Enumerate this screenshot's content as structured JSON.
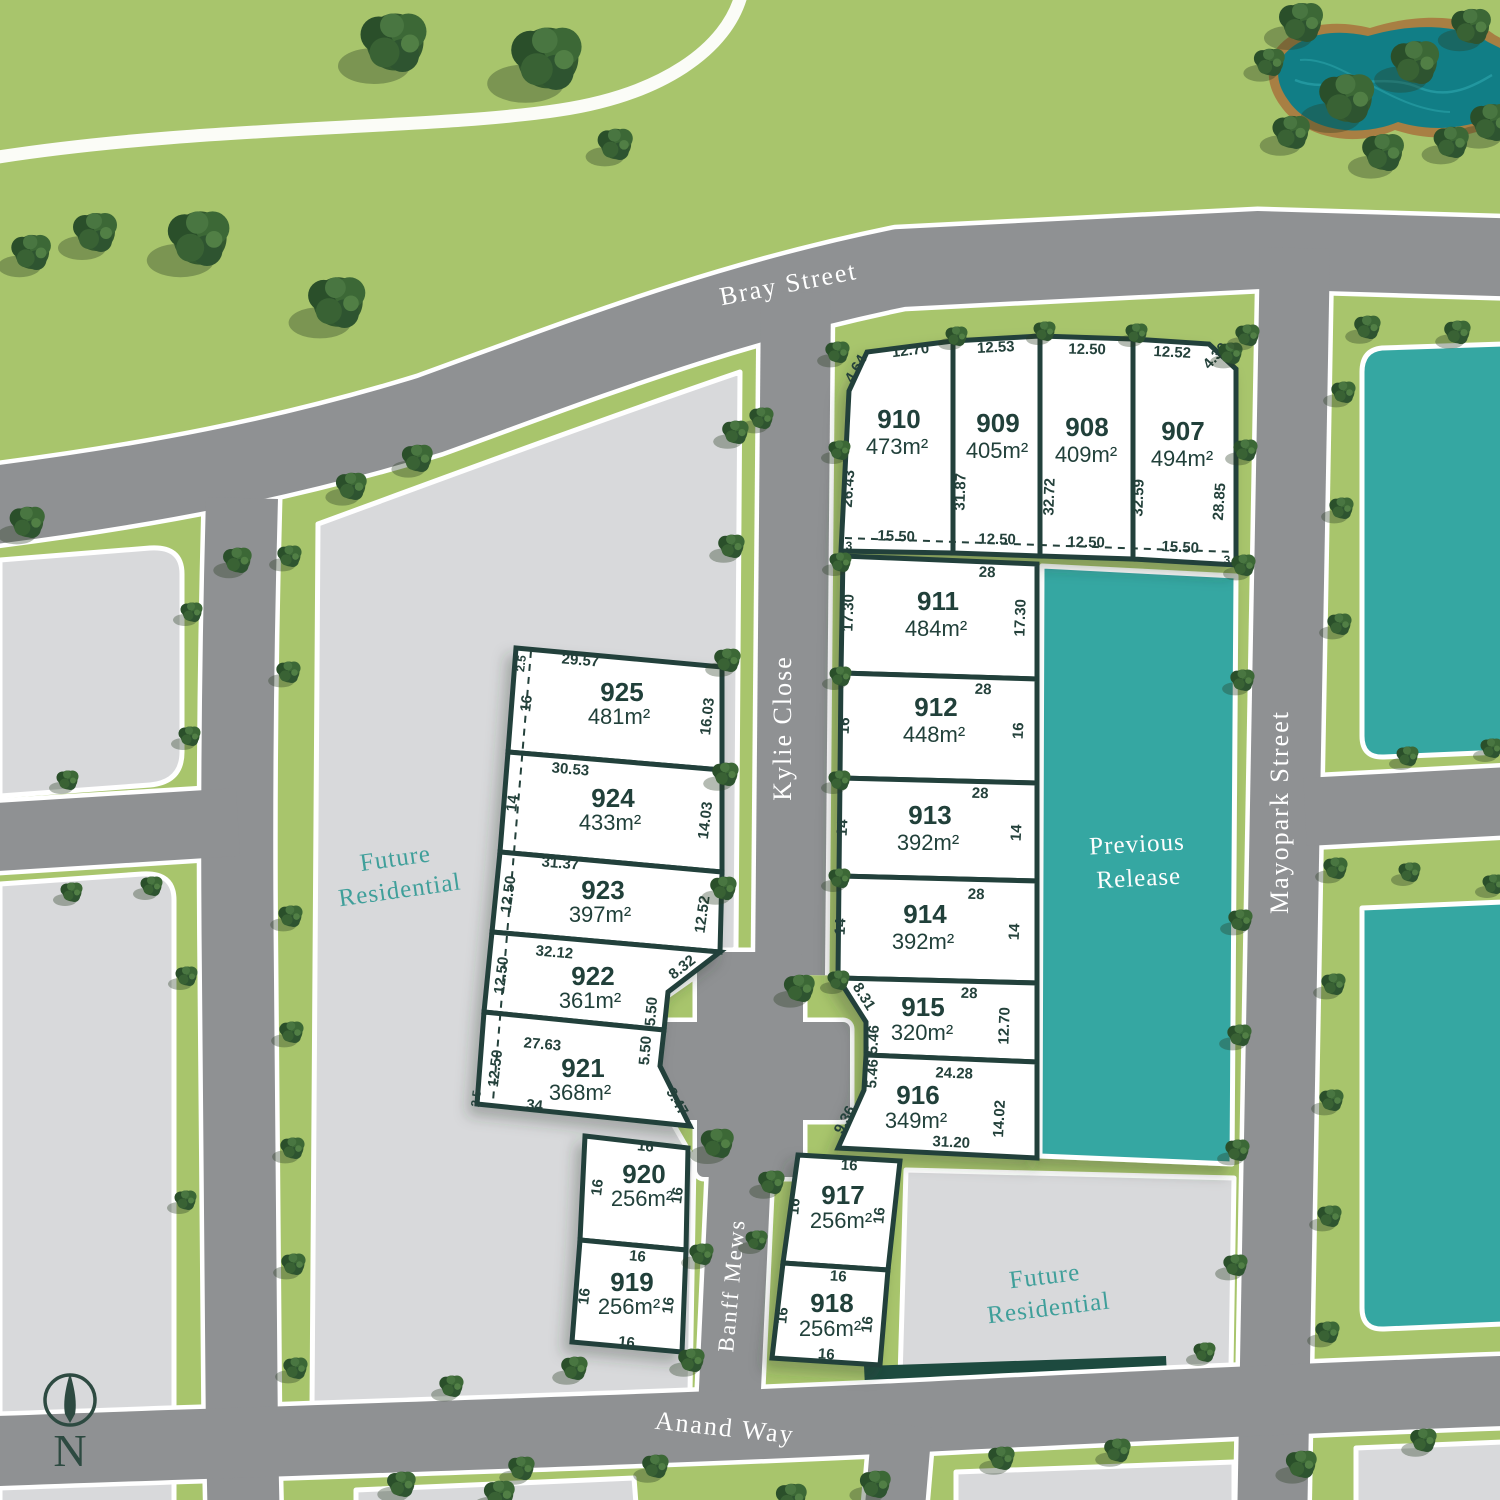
{
  "colors": {
    "grass": "#a8c56c",
    "road": "#8f9193",
    "kerb": "#ffffff",
    "block_gray": "#d8d9db",
    "release_teal": "#35a7a2",
    "lot_fill": "#ffffff",
    "lot_border": "#20403a",
    "text_dark": "#24413b",
    "zone_teal_text": "#3f9f9a",
    "pond_water": "#117e86",
    "pond_sand": "#a87f43",
    "tree_green": "#33592f",
    "hedge_dark": "#1d4a3f"
  },
  "streets": {
    "bray": "Bray Street",
    "kylie": "Kylie Close",
    "mayopark": "Mayopark Street",
    "banff": "Banff Mews",
    "anand": "Anand Way"
  },
  "labels": {
    "future_residential": {
      "line1": "Future",
      "line2": "Residential"
    },
    "previous_release": {
      "line1": "Previous",
      "line2": "Release"
    },
    "compass_n": "N"
  },
  "lots": [
    {
      "number": "907",
      "area": "494m²",
      "dims": [
        "12.52",
        "4.30",
        "32.59",
        "28.85",
        "15.50",
        "3"
      ]
    },
    {
      "number": "908",
      "area": "409m²",
      "dims": [
        "12.50",
        "32.72",
        "12.50"
      ]
    },
    {
      "number": "909",
      "area": "405m²",
      "dims": [
        "12.53",
        "31.87",
        "12.50"
      ]
    },
    {
      "number": "910",
      "area": "473m²",
      "dims": [
        "12.70",
        "4.64",
        "26.43",
        "15.50",
        "3"
      ]
    },
    {
      "number": "911",
      "area": "484m²",
      "dims": [
        "28",
        "17.30",
        "17.30"
      ]
    },
    {
      "number": "912",
      "area": "448m²",
      "dims": [
        "28",
        "16",
        "16"
      ]
    },
    {
      "number": "913",
      "area": "392m²",
      "dims": [
        "28",
        "14",
        "14"
      ]
    },
    {
      "number": "914",
      "area": "392m²",
      "dims": [
        "28",
        "14",
        "14"
      ]
    },
    {
      "number": "915",
      "area": "320m²",
      "dims": [
        "28",
        "8.31",
        "5.46",
        "12.70"
      ]
    },
    {
      "number": "916",
      "area": "349m²",
      "dims": [
        "24.28",
        "5.46",
        "9.36",
        "14.02",
        "31.20"
      ]
    },
    {
      "number": "917",
      "area": "256m²",
      "dims": [
        "16",
        "16",
        "16"
      ]
    },
    {
      "number": "918",
      "area": "256m²",
      "dims": [
        "16",
        "16",
        "16",
        "16"
      ]
    },
    {
      "number": "919",
      "area": "256m²",
      "dims": [
        "16",
        "16",
        "16",
        "16"
      ]
    },
    {
      "number": "920",
      "area": "256m²",
      "dims": [
        "16",
        "16",
        "16"
      ]
    },
    {
      "number": "921",
      "area": "368m²",
      "dims": [
        "27.63",
        "12.50",
        "2.5",
        "34",
        "5.50",
        "9.47"
      ]
    },
    {
      "number": "922",
      "area": "361m²",
      "dims": [
        "32.12",
        "12.50",
        "8.32",
        "5.50"
      ]
    },
    {
      "number": "923",
      "area": "397m²",
      "dims": [
        "31.37",
        "12.50",
        "12.52"
      ]
    },
    {
      "number": "924",
      "area": "433m²",
      "dims": [
        "30.53",
        "14",
        "14.03"
      ]
    },
    {
      "number": "925",
      "area": "481m²",
      "dims": [
        "29.57",
        "2.5",
        "16",
        "16.03"
      ]
    }
  ]
}
